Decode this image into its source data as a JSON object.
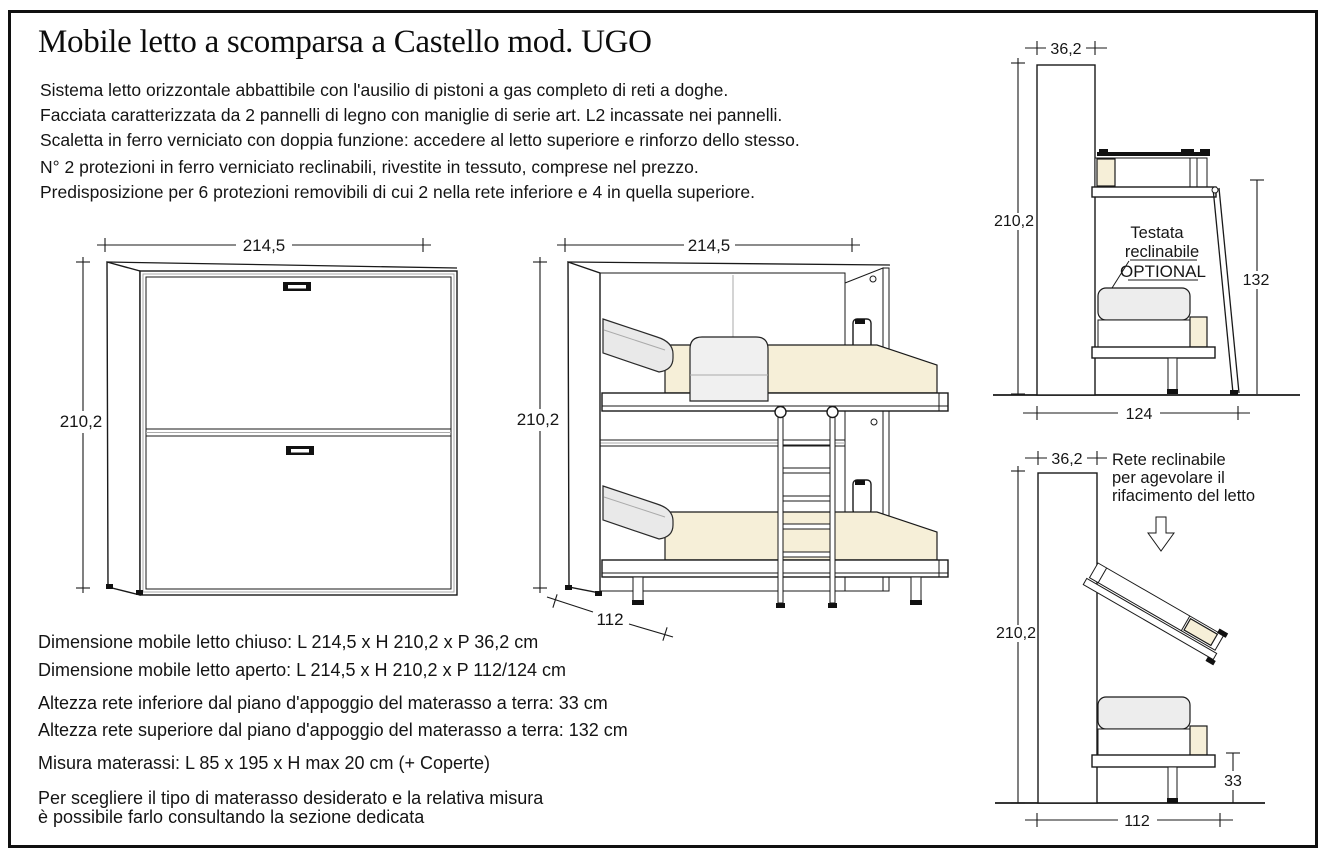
{
  "title": "Mobile letto a scomparsa a Castello mod. UGO",
  "description": {
    "lines": [
      "Sistema letto orizzontale abbattibile con l'ausilio di pistoni a gas completo di reti a doghe.",
      "Facciata caratterizzata da 2 pannelli di legno con maniglie di serie art. L2 incassate nei pannelli.",
      "Scaletta in ferro verniciato con doppia funzione: accedere al letto superiore e rinforzo dello stesso.",
      "N° 2 protezioni in ferro verniciato reclinabili, rivestite in tessuto, comprese nel prezzo.",
      "Predisposizione per 6 protezioni removibili di cui 2 nella rete inferiore e 4 in quella superiore."
    ]
  },
  "specs": {
    "lines": [
      "Dimensione mobile letto chiuso: L 214,5 x H 210,2 x P 36,2 cm",
      "Dimensione mobile letto aperto: L 214,5 x H 210,2 x P 112/124 cm",
      "Altezza rete inferiore dal piano d'appoggio del materasso a terra: 33 cm",
      "Altezza rete superiore dal piano d'appoggio del materasso a terra: 132 cm",
      "Misura materassi: L 85 x 195 x H max 20 cm (+ Coperte)",
      "Per scegliere il tipo di materasso desiderato e la relativa misura",
      "è possibile farlo consultando la sezione dedicata"
    ]
  },
  "drawings": {
    "closed_front": {
      "width": "214,5",
      "height": "210,2"
    },
    "open_front": {
      "width": "214,5",
      "height": "210,2",
      "depth": "112"
    },
    "side_open": {
      "depth_closed": "36,2",
      "height": "210,2",
      "upper_bed_height": "132",
      "depth_open": "124",
      "note": [
        "Testata",
        "reclinabile",
        "OPTIONAL"
      ]
    },
    "side_recline": {
      "depth_closed": "36,2",
      "height": "210,2",
      "lower_bed_height": "33",
      "depth_open": "112",
      "note": [
        "Rete reclinabile",
        "per agevolare il",
        "rifacimento del letto"
      ]
    }
  },
  "colors": {
    "mattress": "#f6efd8",
    "rail": "#e9e9e9",
    "line": "#1a1a1a"
  }
}
